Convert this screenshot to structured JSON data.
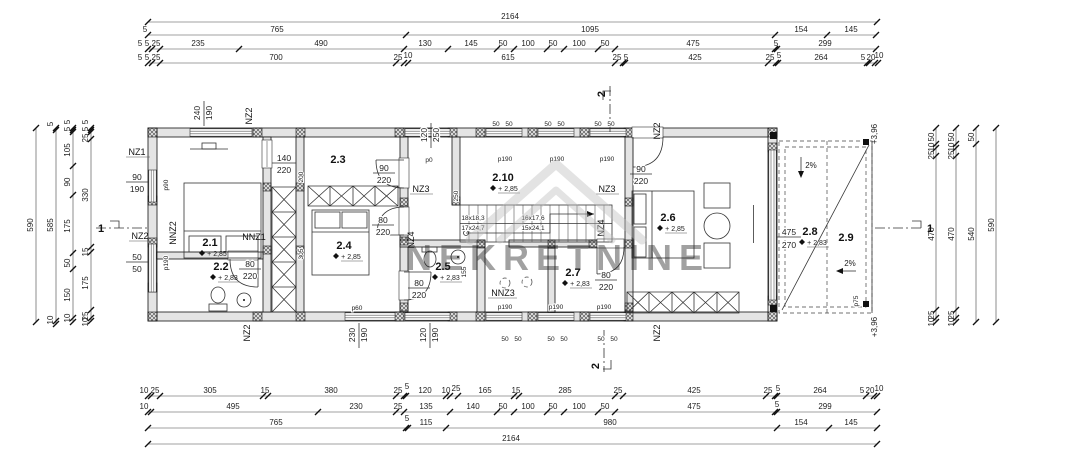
{
  "watermark": {
    "text": "NEKRETNINE"
  },
  "rooms": {
    "r21": {
      "id": "2.1",
      "lvl": "+ 2,85"
    },
    "r22": {
      "id": "2.2",
      "lvl": "+ 2,83"
    },
    "r23": {
      "id": "2.3"
    },
    "r24": {
      "id": "2.4",
      "lvl": "+ 2,85"
    },
    "r25": {
      "id": "2.5",
      "lvl": "+ 2,83"
    },
    "r26": {
      "id": "2.6",
      "lvl": "+ 2,85"
    },
    "r27": {
      "id": "2.7",
      "lvl": "+ 2,83"
    },
    "r28": {
      "id": "2.8",
      "lvl": "+ 2,83"
    },
    "r29": {
      "id": "2.9"
    },
    "r210": {
      "id": "2.10",
      "lvl": "+ 2,85"
    }
  },
  "dims": {
    "t1": [
      "2164"
    ],
    "t2": [
      "5",
      "765",
      "1095",
      "154",
      "145"
    ],
    "t3": [
      "5",
      "5",
      "25",
      "235",
      "490",
      "130",
      "145",
      "50",
      "100",
      "50",
      "100",
      "50",
      "475",
      "5",
      "299"
    ],
    "t4": [
      "5",
      "5",
      "25",
      "700",
      "25",
      "10",
      "615",
      "25",
      "5",
      "425",
      "25",
      "5",
      "264",
      "5",
      "20",
      "10"
    ],
    "b1": [
      "10",
      "25",
      "305",
      "15",
      "380",
      "25",
      "5",
      "120",
      "10",
      "25",
      "165",
      "15",
      "285",
      "25",
      "425",
      "25",
      "5",
      "264",
      "5",
      "20",
      "10"
    ],
    "b2": [
      "10",
      "495",
      "230",
      "25",
      "135",
      "140",
      "50",
      "100",
      "50",
      "100",
      "50",
      "475",
      "5",
      "299"
    ],
    "b3": [
      "765",
      "5",
      "115",
      "980",
      "154",
      "145"
    ],
    "b4": [
      "2164"
    ],
    "l1": [
      "590"
    ],
    "l2": [
      "5",
      "585",
      "10"
    ],
    "l3": [
      "5",
      "5",
      "105",
      "90",
      "175",
      "50",
      "150",
      "10"
    ],
    "l4": [
      "5",
      "5",
      "25",
      "330",
      "15",
      "175",
      "25",
      "10"
    ],
    "r1": [
      "50",
      "10",
      "25",
      "470",
      "25",
      "10"
    ],
    "r2": [
      "50",
      "10",
      "25",
      "470",
      "25",
      "10"
    ],
    "r3": [
      "50",
      "540"
    ],
    "r4": [
      "590"
    ],
    "fifty": "50",
    "i200": "200",
    "i305": "305",
    "i250": "250",
    "i155": "155"
  },
  "fr": {
    "f140_220": [
      "140",
      "220"
    ],
    "f90_220": [
      "90",
      "220"
    ],
    "f80_220": [
      "80",
      "220"
    ],
    "f475_270": [
      "475",
      "270"
    ],
    "f90_190": [
      "90",
      "190"
    ],
    "f50_50": [
      "50",
      "50"
    ],
    "v240_190": [
      "240",
      "190"
    ],
    "v120_250": [
      "120",
      "250"
    ],
    "v230_190": [
      "230",
      "190"
    ],
    "v120_190": [
      "120",
      "190"
    ]
  },
  "walls": {
    "nz1": "NZ1",
    "nz2": "NZ2",
    "nz3": "NZ3",
    "nz4": "NZ4",
    "nnz1": "NNZ1",
    "nnz2": "NNZ2",
    "nnz3": "NNZ3"
  },
  "openings": {
    "p0": "p0",
    "p60": "p60",
    "p75": "p75",
    "p90": "p90",
    "p190": "p190"
  },
  "stairs": {
    "f1a": "18x18,3",
    "f1b": "17x24,7",
    "f2a": "16x17,6",
    "f2b": "15x24,1"
  },
  "terrace": {
    "slope": "2%",
    "level": "+3,96"
  },
  "sections": {
    "one": "1",
    "two": "2"
  }
}
